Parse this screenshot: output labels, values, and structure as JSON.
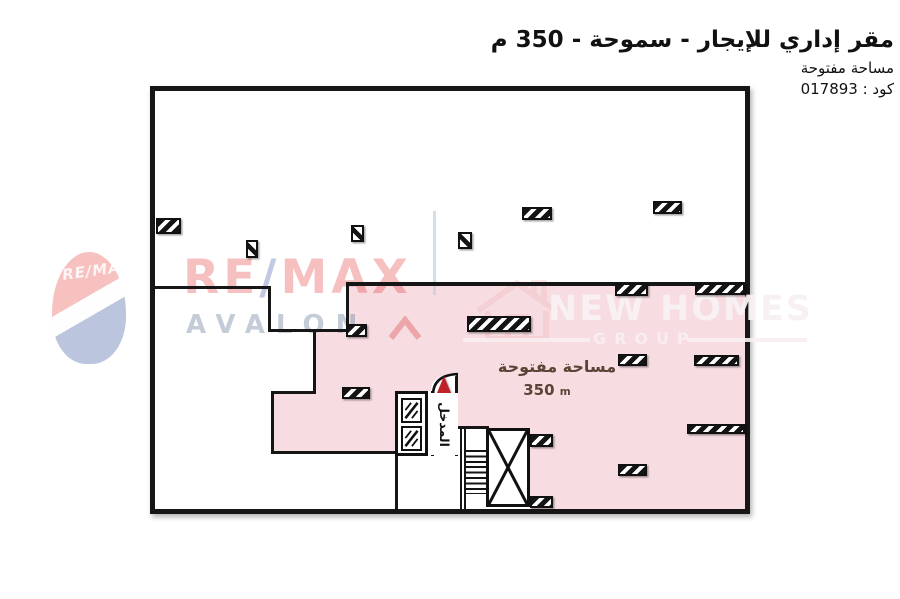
{
  "header": {
    "title": "مقر إداري للإيجار - سموحة - 350 م",
    "subtitle": "مساحة مفتوحة",
    "code_line": "كود : 017893"
  },
  "plan": {
    "open_space": {
      "label": "مساحة مفتوحة",
      "area_value": "350",
      "area_unit": "m"
    },
    "entrance": {
      "label": "المدخل"
    },
    "colors": {
      "open_space_fill": "#f7dde1",
      "wall": "#161616",
      "entrance_arrow": "#bf2228"
    },
    "walls": [
      {
        "x": 0,
        "y": 195,
        "w": 115,
        "h": 3
      },
      {
        "x": 113,
        "y": 195,
        "w": 3,
        "h": 46
      },
      {
        "x": 113,
        "y": 238,
        "w": 80,
        "h": 3
      },
      {
        "x": 158,
        "y": 238,
        "w": 3,
        "h": 65
      },
      {
        "x": 116,
        "y": 300,
        "w": 45,
        "h": 3
      },
      {
        "x": 116,
        "y": 300,
        "w": 3,
        "h": 63
      },
      {
        "x": 116,
        "y": 360,
        "w": 127,
        "h": 3
      },
      {
        "x": 191,
        "y": 191,
        "w": 399,
        "h": 4
      },
      {
        "x": 191,
        "y": 191,
        "w": 3,
        "h": 50
      },
      {
        "x": 240,
        "y": 300,
        "w": 3,
        "h": 118
      },
      {
        "x": 300,
        "y": 335,
        "w": 34,
        "h": 3
      },
      {
        "x": 276,
        "y": 300,
        "w": 3,
        "h": 65
      },
      {
        "x": 300,
        "y": 283,
        "w": 3,
        "h": 82
      },
      {
        "x": 305,
        "y": 337,
        "w": 2,
        "h": 81
      },
      {
        "x": 309,
        "y": 337,
        "w": 2,
        "h": 81
      }
    ],
    "columns": [
      {
        "x": 1,
        "y": 127,
        "w": 25,
        "h": 16,
        "kind": "wide"
      },
      {
        "x": 91,
        "y": 149,
        "w": 12,
        "h": 18,
        "kind": "small"
      },
      {
        "x": 196,
        "y": 134,
        "w": 13,
        "h": 17,
        "kind": "small"
      },
      {
        "x": 303,
        "y": 141,
        "w": 14,
        "h": 17,
        "kind": "small"
      },
      {
        "x": 367,
        "y": 116,
        "w": 30,
        "h": 13,
        "kind": "wide"
      },
      {
        "x": 498,
        "y": 110,
        "w": 29,
        "h": 13,
        "kind": "wide"
      },
      {
        "x": 460,
        "y": 192,
        "w": 33,
        "h": 13,
        "kind": "wide"
      },
      {
        "x": 540,
        "y": 192,
        "w": 50,
        "h": 12,
        "kind": "wide"
      },
      {
        "x": 191,
        "y": 233,
        "w": 21,
        "h": 13,
        "kind": "wide"
      },
      {
        "x": 187,
        "y": 296,
        "w": 28,
        "h": 12,
        "kind": "wide"
      },
      {
        "x": 312,
        "y": 225,
        "w": 64,
        "h": 16,
        "kind": "wide"
      },
      {
        "x": 463,
        "y": 263,
        "w": 29,
        "h": 12,
        "kind": "wide"
      },
      {
        "x": 539,
        "y": 264,
        "w": 45,
        "h": 11,
        "kind": "wide"
      },
      {
        "x": 532,
        "y": 333,
        "w": 58,
        "h": 10,
        "kind": "wide"
      },
      {
        "x": 463,
        "y": 373,
        "w": 29,
        "h": 12,
        "kind": "wide"
      },
      {
        "x": 375,
        "y": 343,
        "w": 23,
        "h": 13,
        "kind": "wide"
      },
      {
        "x": 375,
        "y": 405,
        "w": 23,
        "h": 12,
        "kind": "wide"
      }
    ]
  },
  "watermarks": {
    "remax": {
      "re": "RE",
      "slash": "/",
      "max": "MAX",
      "brand2": "AVALON",
      "balloon_text": "RE/MA",
      "red": "#e01f26",
      "blue": "#24409c",
      "gray": "#7d8fa9"
    },
    "newhomes": {
      "name": "NEW HOMES",
      "sub": "GROUP"
    }
  }
}
